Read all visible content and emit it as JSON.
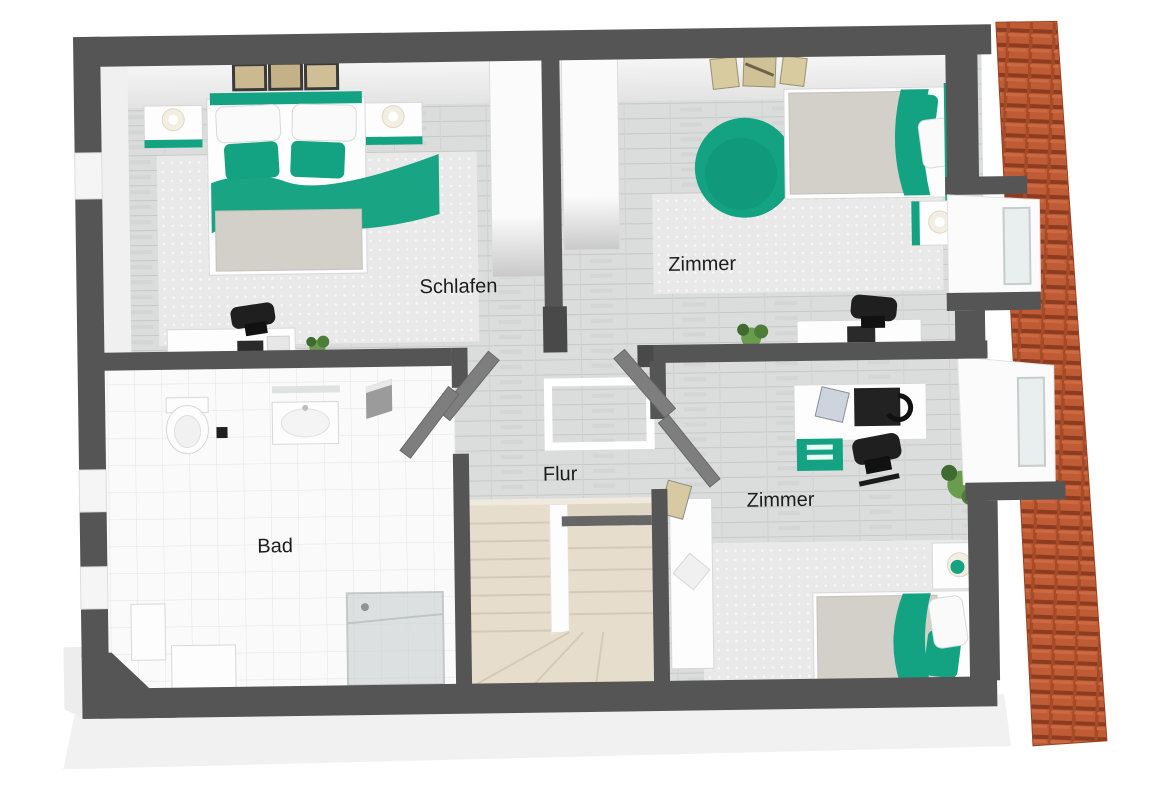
{
  "rooms": {
    "schlafen": {
      "label": "Schlafen"
    },
    "zimmer_top": {
      "label": "Zimmer"
    },
    "bad": {
      "label": "Bad"
    },
    "flur": {
      "label": "Flur"
    },
    "zimmer_bottom": {
      "label": "Zimmer"
    }
  },
  "colors": {
    "accent_teal": "#14a382",
    "accent_teal_dark": "#0e8a6d",
    "roof_tile": "#c05c35",
    "roof_tile_shadow": "#8c3c20",
    "roof_tile_groove": "#a54b28",
    "wall_dark": "#555555",
    "floor_plank": "#dbdcdc",
    "floor_plank_line": "#c7c8c8",
    "bath_tile": "#fafafa",
    "bath_tile_line": "#e4e4e4",
    "stair_beige": "#e7ddcc",
    "rug_grey": "#e9e9e9",
    "label_text": "#1c1c1c"
  },
  "furniture": {
    "schlafen": [
      "double-bed",
      "teal-headboard",
      "two-white-pillows",
      "two-teal-cushions",
      "teal-blanket",
      "nightstand-left",
      "nightstand-right",
      "two-lamps",
      "three-wall-pictures",
      "area-rug",
      "desk",
      "office-chair",
      "small-plant",
      "wardrobe"
    ],
    "zimmer_top": [
      "single-bed",
      "teal-blanket",
      "teal-pouf",
      "nightstand",
      "lamp",
      "wall-posters",
      "area-rug",
      "desk",
      "office-chair",
      "plant",
      "wardrobe",
      "dormer-window"
    ],
    "bad": [
      "toilet",
      "sink-vanity",
      "mirror",
      "shower-cabin",
      "cabinet",
      "washer",
      "partition"
    ],
    "flur": [
      "staircase",
      "floor-opening-marker",
      "four-open-doors"
    ],
    "zimmer_bottom": [
      "single-bed",
      "teal-headboard",
      "teal-pillows",
      "white-pillow",
      "nightstand",
      "lamp",
      "desk",
      "monitor",
      "teal-drawer-unit",
      "office-chair",
      "bookshelf",
      "leaning-picture",
      "plant",
      "area-rug",
      "dormer-window"
    ]
  },
  "structure": {
    "roof": "tiled-roof-strip-right",
    "stairwell": "u-shaped-staircase",
    "windows_left_wall": 3,
    "dormers_right": 2
  }
}
